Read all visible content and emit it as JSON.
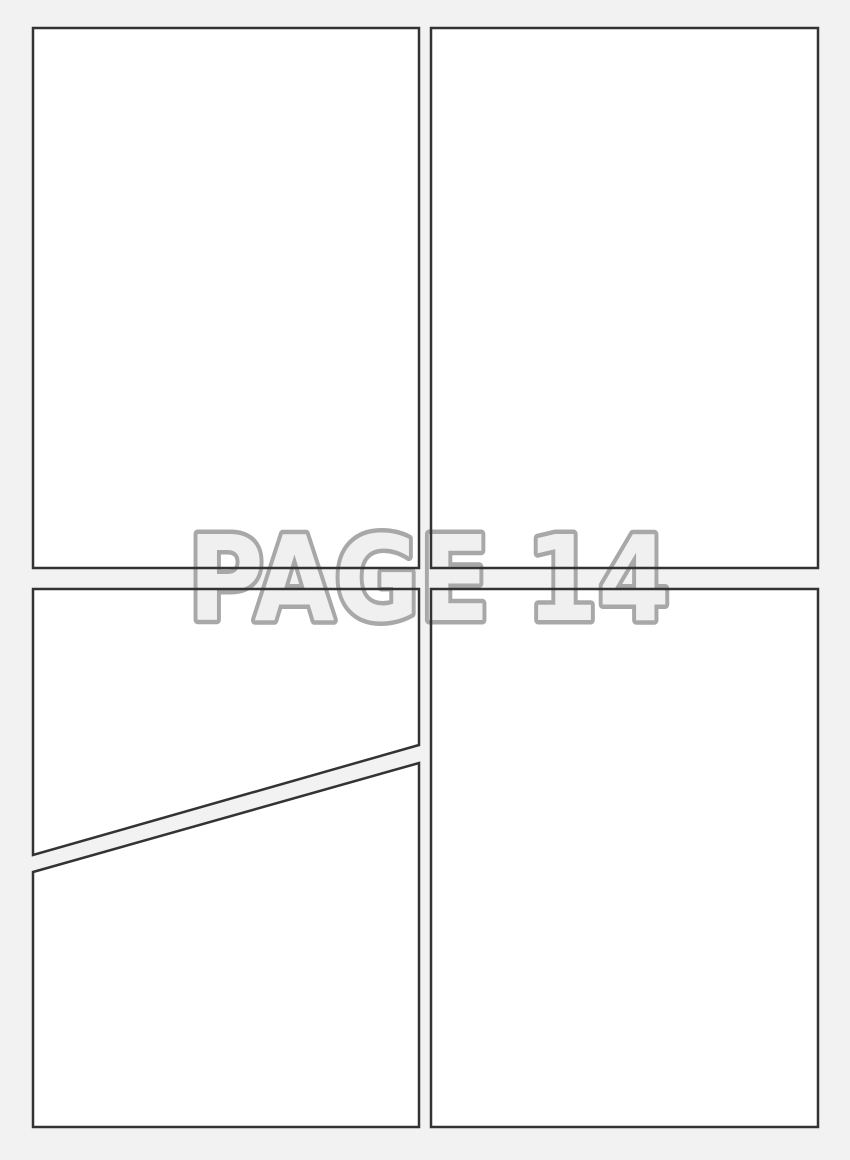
{
  "page": {
    "label": "PAGE 14"
  },
  "theme": {
    "background": "#f2f2f2",
    "panel_fill": "#ffffff",
    "panel_border": "#333333",
    "label_fill": "#f0f0f0",
    "label_outline": "#a8a8a8"
  }
}
